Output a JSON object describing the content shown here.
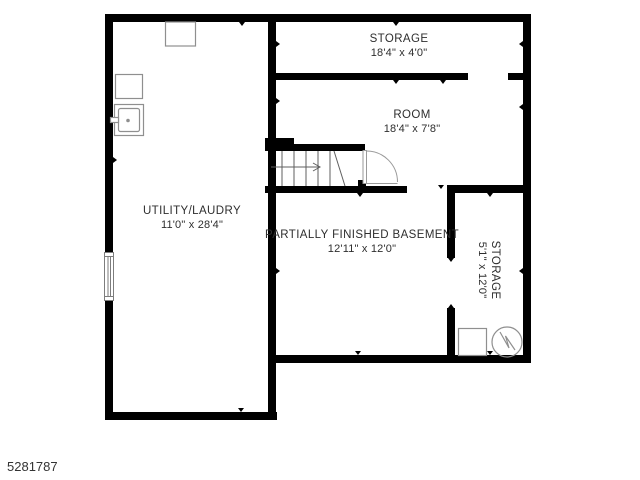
{
  "meta": {
    "ref_number": "5281787"
  },
  "colors": {
    "wall": "#000000",
    "fixture_line": "#8f8f8f",
    "stair_line": "#5f5f5f",
    "text": "#2e2e2e",
    "background": "#ffffff"
  },
  "rooms": {
    "storage_top": {
      "label": "STORAGE",
      "dims": "18'4\" x 4'0\""
    },
    "room": {
      "label": "ROOM",
      "dims": "18'4\" x 7'8\""
    },
    "utility": {
      "label": "UTILITY/LAUDRY",
      "dims": "11'0\" x 28'4\""
    },
    "basement": {
      "label": "PARTIALLY FINISHED BASEMENT",
      "dims": "12'11\" x 12'0\""
    },
    "storage_right": {
      "label": "STORAGE",
      "dims": "5'1\" x 12'0\""
    }
  },
  "fixtures": {
    "chimney": "chimney-box",
    "appliance": "appliance-box",
    "sink": "laundry-sink",
    "storage_box": "storage-box",
    "pump": "sump-pump",
    "window": "left-wall-window",
    "stairs": "staircase-up",
    "door": "door-swing"
  }
}
